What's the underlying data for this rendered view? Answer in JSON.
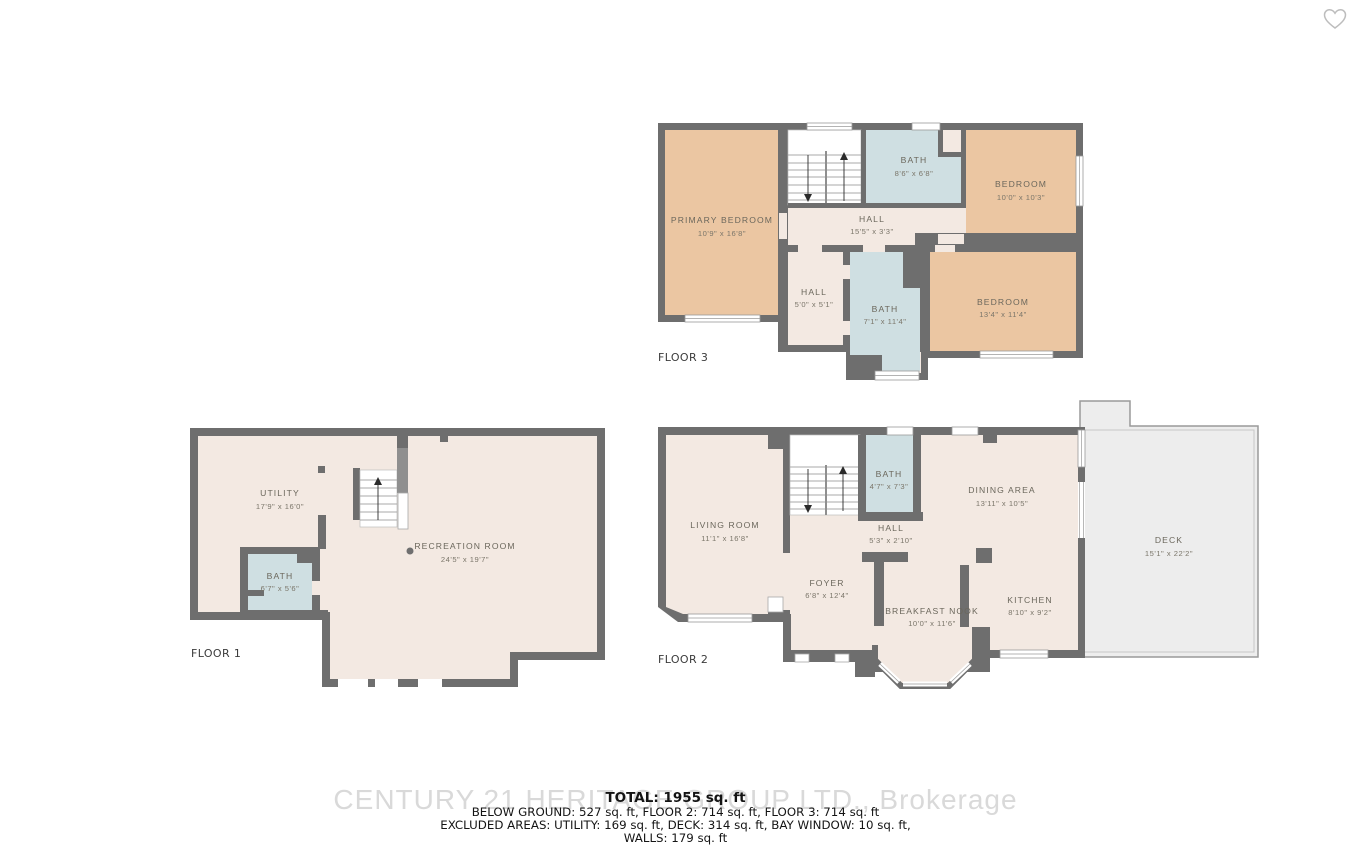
{
  "header": {
    "favorite_icon": "heart-outline"
  },
  "colors": {
    "wall": "#6e6e6e",
    "room_cream": "#f3e9e2",
    "bedroom_tan": "#ebc6a2",
    "bath_blue": "#cfdfe2",
    "deck_gray": "#ededed",
    "label_text": "#6b675c",
    "summary_text": "#141414",
    "watermark_text": "#d9d9d9",
    "heart_outline": "#bdbdbd"
  },
  "floors": [
    {
      "id": "floor-1",
      "label": "FLOOR 1",
      "rooms": [
        {
          "name": "UTILITY",
          "dims": "17'9\" x 16'0\""
        },
        {
          "name": "RECREATION ROOM",
          "dims": "24'5\" x 19'7\""
        },
        {
          "name": "BATH",
          "dims": "6'7\" x 5'6\""
        }
      ]
    },
    {
      "id": "floor-2",
      "label": "FLOOR 2",
      "rooms": [
        {
          "name": "LIVING ROOM",
          "dims": "11'1\" x 16'8\""
        },
        {
          "name": "BATH",
          "dims": "4'7\" x 7'3\""
        },
        {
          "name": "DINING AREA",
          "dims": "13'11\" x 10'5\""
        },
        {
          "name": "HALL",
          "dims": "5'3\" x 2'10\""
        },
        {
          "name": "FOYER",
          "dims": "6'8\" x 12'4\""
        },
        {
          "name": "BREAKFAST NOOK",
          "dims": "10'0\" x 11'6\""
        },
        {
          "name": "KITCHEN",
          "dims": "8'10\" x 9'2\""
        },
        {
          "name": "DECK",
          "dims": "15'1\" x 22'2\""
        }
      ]
    },
    {
      "id": "floor-3",
      "label": "FLOOR 3",
      "rooms": [
        {
          "name": "PRIMARY BEDROOM",
          "dims": "10'9\" x 16'8\""
        },
        {
          "name": "BATH",
          "dims": "8'6\" x 6'8\""
        },
        {
          "name": "BEDROOM",
          "dims": "10'0\" x 10'3\""
        },
        {
          "name": "HALL",
          "dims": "15'5\" x 3'3\""
        },
        {
          "name": "HALL",
          "dims": "5'0\" x 5'1\""
        },
        {
          "name": "BATH",
          "dims": "7'1\" x 11'4\""
        },
        {
          "name": "BEDROOM",
          "dims": "13'4\" x 11'4\""
        }
      ]
    }
  ],
  "summary": {
    "total": "TOTAL: 1955 sq. ft",
    "line2": "BELOW GROUND: 527 sq. ft, FLOOR 2: 714 sq. ft, FLOOR 3: 714 sq. ft",
    "line3": "EXCLUDED AREAS: UTILITY: 169 sq. ft, DECK: 314 sq. ft, BAY WINDOW: 10 sq. ft,",
    "line4": "WALLS: 179 sq. ft"
  },
  "watermark": "CENTURY 21 HERITAGE GROUP LTD., Brokerage"
}
